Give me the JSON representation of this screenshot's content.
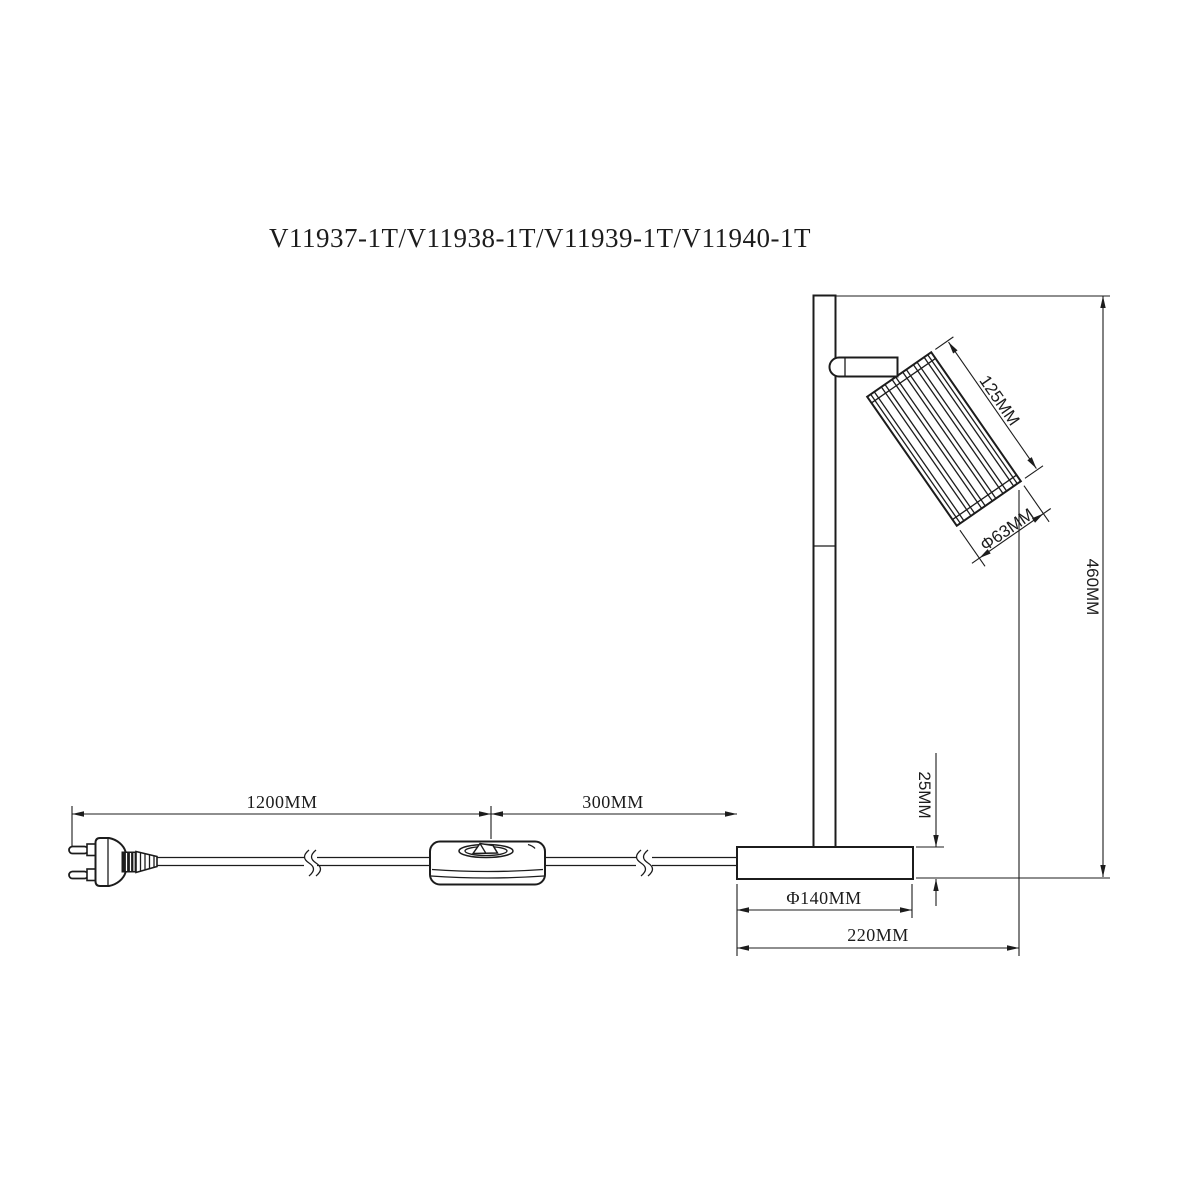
{
  "title": "V11937-1T/V11938-1T/V11939-1T/V11940-1T",
  "drawing": {
    "type": "technical dimension drawing of a table lamp with cord, inline switch and EU plug"
  },
  "dimensions": {
    "cord_length": "1200MM",
    "switch_to_base": "300MM",
    "base_diameter": "Φ140MM",
    "overall_depth": "220MM",
    "base_height": "25MM",
    "overall_height": "460MM",
    "shade_length": "125MM",
    "shade_diameter": "Φ63MM"
  },
  "colors": {
    "line": "#1c1c1c",
    "background": "#ffffff"
  }
}
